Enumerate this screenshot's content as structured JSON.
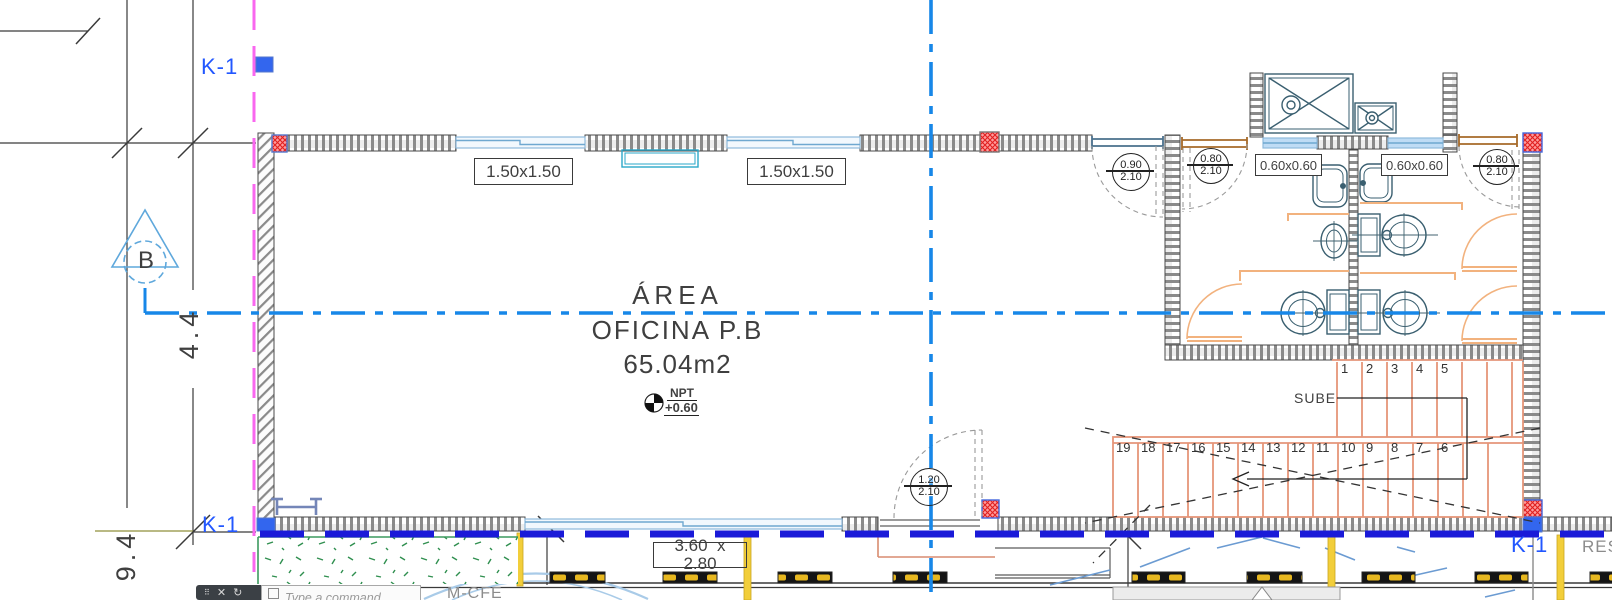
{
  "colors": {
    "centerline_blue": "#1787E8",
    "site_boundary_blue": "#1A1AD8",
    "k_label_blue": "#2257FF",
    "magenta_line": "#F967EF",
    "stair_salmon": "#E59579",
    "stall_orange": "#F2B27E",
    "fixture_teal": "#3A5F70",
    "speed_bump_yellow": "#E8B820",
    "landscape_green": "#2F8F4F"
  },
  "grid_refs": {
    "k1_top": "K-1",
    "k1_bottom_left": "K-1",
    "k1_bottom_right": "K-1",
    "bubble_label": "B",
    "dim_vertical_upper": "4.4",
    "dim_vertical_lower": "9.4"
  },
  "room_label": {
    "line1": "ÁREA",
    "line2": "OFICINA P.B",
    "line3": "65.04m2"
  },
  "level_marker": {
    "label": "NPT",
    "value": "+0.60"
  },
  "window_tags": {
    "w1": "1.50x1.50",
    "w2": "1.50x1.50",
    "w3": "0.60x0.60",
    "w4": "0.60x0.60"
  },
  "door_tags": {
    "d1": {
      "top": "0.90",
      "bottom": "2.10"
    },
    "d2": {
      "top": "0.80",
      "bottom": "2.10"
    },
    "d3": {
      "top": "0.80",
      "bottom": "2.10"
    },
    "d4": {
      "top": "1.20",
      "bottom": "2.10"
    }
  },
  "stairs": {
    "direction_label": "SUBE",
    "upper_treads": [
      "1",
      "2",
      "3",
      "4",
      "5"
    ],
    "lower_treads": [
      "19",
      "18",
      "17",
      "16",
      "15",
      "14",
      "13",
      "12",
      "11",
      "10",
      "9",
      "8",
      "7",
      "6"
    ]
  },
  "parking": {
    "stall_dim_line1": "3.60  x",
    "stall_dim_line2": "2.80"
  },
  "annotations": {
    "label_mcfe": "M-CFE",
    "label_res": "RES"
  },
  "command_bar": {
    "placeholder": "Type a command"
  }
}
